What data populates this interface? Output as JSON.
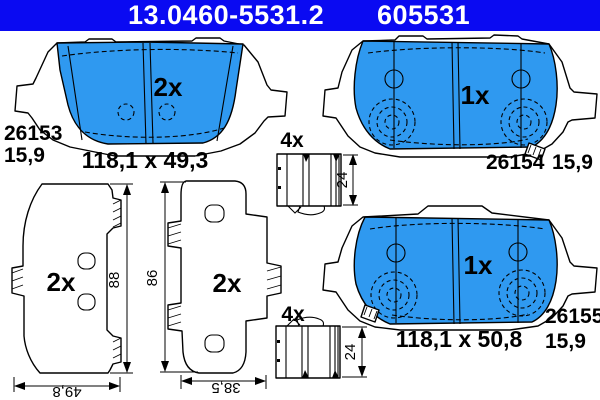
{
  "header": {
    "catalog_number": "13.0460-5531.2",
    "reference_number": "605531"
  },
  "colors": {
    "header_blue": "#0a0af2",
    "pad_blue": "#2f99f0",
    "line": "#000000",
    "background": "#ffffff"
  },
  "pads": {
    "top_left": {
      "quantity": "2x",
      "part_id": "26153",
      "thickness": "15,9",
      "size": "118,1 x 49,3"
    },
    "top_right": {
      "quantity": "1x",
      "part_id": "26154",
      "thickness": "15,9"
    },
    "bottom_right": {
      "quantity": "1x",
      "part_id": "26155",
      "thickness": "15,9",
      "size": "118,1 x 50,8"
    }
  },
  "plates": {
    "left": {
      "quantity": "2x",
      "height": "88",
      "width": "49,8"
    },
    "middle": {
      "quantity": "2x",
      "height": "86",
      "width": "38,5"
    }
  },
  "clips": {
    "top": {
      "quantity": "4x",
      "height": "24"
    },
    "bottom": {
      "quantity": "4x",
      "height": "24"
    }
  }
}
